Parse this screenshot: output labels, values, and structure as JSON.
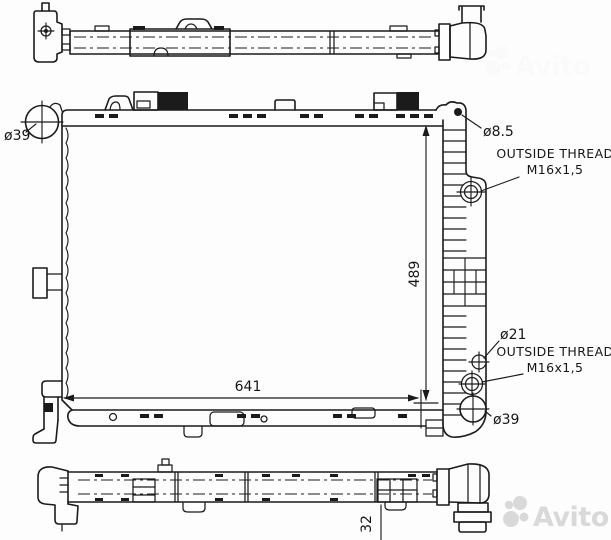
{
  "colors": {
    "ink": "#1b1b1b",
    "watermark": "#d9d9d9",
    "background": "#fdfdfd"
  },
  "annotations": {
    "filler_neck_diameter": "ø39",
    "bleed_hole_diameter": "ø8.5",
    "upper_thread_note_line1": "OUTSIDE THREAD",
    "upper_thread_note_line2": "M16x1,5",
    "sensor_port_diameter": "ø21",
    "lower_thread_note_line1": "OUTSIDE THREAD",
    "lower_thread_note_line2": "M16x1,5",
    "outlet_diameter": "ø39",
    "dim_width": "641",
    "dim_height": "489",
    "dim_depth": "32"
  },
  "watermark": {
    "brand": "Avito"
  }
}
